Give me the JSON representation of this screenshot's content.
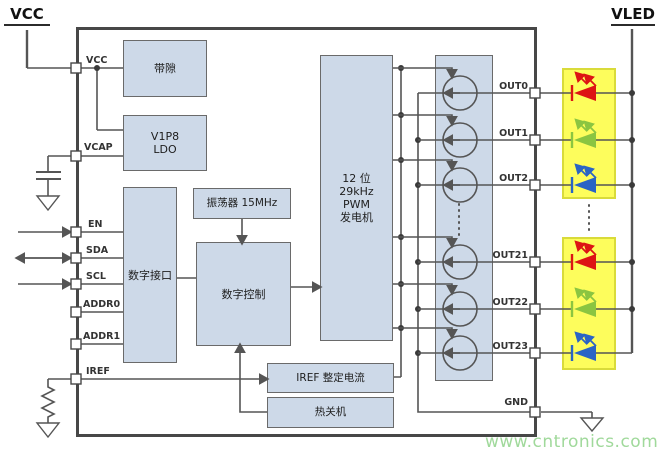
{
  "rails": {
    "vcc_label": "VCC",
    "vled_label": "VLED"
  },
  "chip": {
    "blocks": {
      "bandgap": "带隙",
      "ldo_line1": "V1P8",
      "ldo_line2": "LDO",
      "digital_interface": "数字接口",
      "oscillator": "振荡器 15MHz",
      "digital_control": "数字控制",
      "pwm_line1": "12 位",
      "pwm_line2": "29kHz",
      "pwm_line3": "PWM",
      "pwm_line4": "发电机",
      "iref_trim": "IREF 整定电流",
      "thermal_shutdown": "热关机"
    },
    "pins": {
      "left": [
        "VCC",
        "VCAP",
        "EN",
        "SDA",
        "SCL",
        "ADDR0",
        "ADDR1",
        "IREF"
      ],
      "right_out": [
        "OUT0",
        "OUT1",
        "OUT2",
        "OUT21",
        "OUT22",
        "OUT23"
      ],
      "gnd": "GND"
    }
  },
  "watermark": "www.cntronics.com",
  "colors": {
    "wire": "#555555",
    "chip_border": "#474747",
    "block_fill": "#cdd9e8",
    "block_border": "#6a6a6a",
    "highlight_fill": "#fdfd5c",
    "highlight_border": "#d9db3a",
    "led_red": "#dd1414",
    "led_green": "#8bc541",
    "led_blue": "#2a64c5",
    "watermark_green": "#a0d99b"
  }
}
